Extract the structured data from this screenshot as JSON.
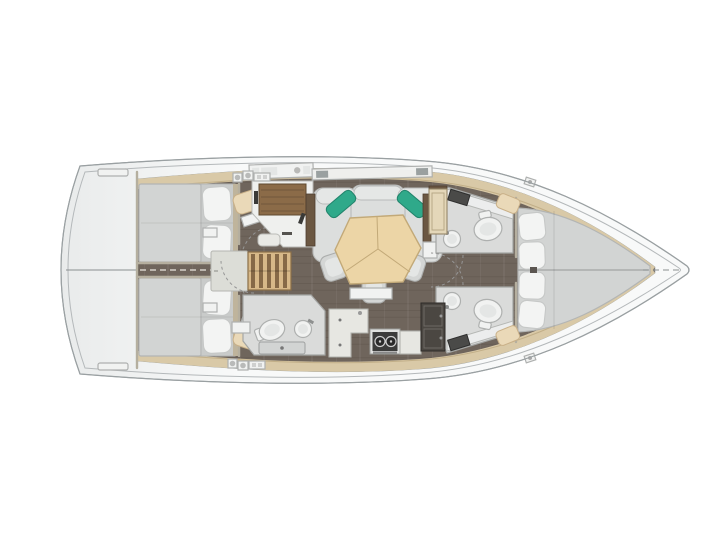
{
  "scene": {
    "type": "yacht-interior-floor-plan",
    "orientation": "bow-right",
    "description": "Top-down interior layout plan of a sailing yacht: two aft double cabins, saloon with U-settee and tri-fold table, galley, navigation station, three heads and a forward V-berth cabin"
  },
  "rooms": [
    {
      "id": "stern-deck",
      "label": "Stern deck / transom"
    },
    {
      "id": "aft-cabin-port",
      "label": "Aft double cabin (port)",
      "furniture": [
        "double-berth",
        "two-pillows",
        "vanity-seat",
        "side-cabinet"
      ]
    },
    {
      "id": "aft-cabin-starboard",
      "label": "Aft double cabin (starboard)",
      "furniture": [
        "double-berth",
        "two-pillows",
        "vanity-seat",
        "side-cabinet"
      ]
    },
    {
      "id": "companionway",
      "label": "Companionway steps with engine box"
    },
    {
      "id": "nav-station",
      "label": "Navigation station with chart table"
    },
    {
      "id": "saloon",
      "label": "Saloon with U-shaped settee, teal cushions, tri-fold table and three stools"
    },
    {
      "id": "galley",
      "label": "Galley with L-counter and two-burner stove"
    },
    {
      "id": "aft-head",
      "label": "Aft head with toilet, washbasin and shower tray"
    },
    {
      "id": "fwd-head-port",
      "label": "Forward head (port) with toilet and washbasin"
    },
    {
      "id": "fwd-head-starboard",
      "label": "Forward head (starboard) with toilet, washbasin and wardrobe"
    },
    {
      "id": "v-berth",
      "label": "Forward cabin with V-berth and four pillows"
    }
  ],
  "counts": {
    "cabins": 3,
    "heads": 3,
    "saloon_stools": 3,
    "teal_cushions": 2,
    "stove_burners": 2,
    "vberth_pillows": 4,
    "aft_cabin_pillows_each": 2
  },
  "palette": {
    "bg": "#ffffff",
    "hullLine": "#9aa0a2",
    "toeRail": "#b4b8ba",
    "floor": "#6f655c",
    "floorGrain": "#2e2922",
    "liner": "#d9c9a7",
    "linerEdge": "#b9a57e",
    "mattress": "#d2d4d3",
    "mattressDim": "#c9cbca",
    "mattressEdge": "#b3b5b4",
    "pillow": "#f3f4f3",
    "pillowEdge": "#c6c8c7",
    "sofa": "#dcdedd",
    "sofaTop": "#e5e7e6",
    "sofaEdge": "#b9bbba",
    "cushionTeal": "#2fa98a",
    "tableWood": "#ecd5a6",
    "tableEdge": "#c2a978",
    "stool": "#d4d6d5",
    "stairWood": "#d7b888",
    "stairSlat": "#7d6140",
    "chartWood": "#8b6b48",
    "counter": "#e7e7e2",
    "counterEdge": "#b2b3ae",
    "bathFloor": "#dadbda",
    "bathEdge": "#a4a6a4",
    "fixture": "#f1f2f1",
    "fixtureEdge": "#aeb0af",
    "darkWood": "#6b5742",
    "darkCabinet": "#4b4742",
    "doorBeige": "#e4d7b9",
    "seatBeige": "#ead9b8",
    "seatBeigeEdge": "#c9b088",
    "wallEdge": "#b5af9f",
    "arc": "#969696",
    "centerline": "#8a8f90"
  }
}
